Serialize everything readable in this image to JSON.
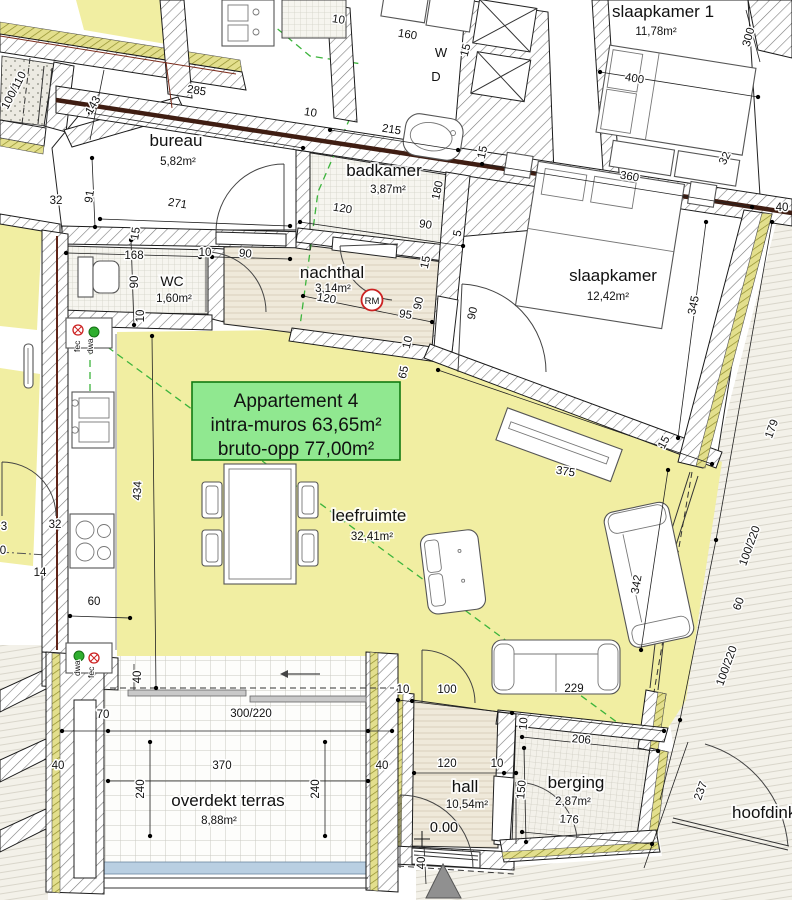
{
  "plan": {
    "info_box": {
      "line1": "Appartement  4",
      "line2": "intra-muros 63,65m²",
      "line3": "bruto-opp 77,00m²"
    },
    "rooms": {
      "bureau": {
        "name": "bureau",
        "area": "5,82m²"
      },
      "badkamer": {
        "name": "badkamer",
        "area": "3,87m²"
      },
      "slaapkamer1": {
        "name": "slaapkamer 1",
        "area": "11,78m²"
      },
      "slaapkamer": {
        "name": "slaapkamer",
        "area": "12,42m²"
      },
      "wc": {
        "name": "WC",
        "area": "1,60m²"
      },
      "nachthal": {
        "name": "nachthal",
        "area": "3,14m²"
      },
      "leefruimte": {
        "name": "leefruimte",
        "area": "32,41m²"
      },
      "terras": {
        "name": "overdekt terras",
        "area": "8,88m²"
      },
      "hall": {
        "name": "hall",
        "area": "10,54m²",
        "level": "0.00"
      },
      "berging": {
        "name": "berging",
        "area": "2,87m²"
      },
      "hoofdinkom": {
        "name": "hoofdinkom"
      }
    },
    "badges": {
      "rm": "RM",
      "w": "W",
      "d": "D",
      "fec": "fec",
      "dwa": "dwa"
    },
    "colors": {
      "room_yellow": "#f1eea2",
      "info_green": "#90e890",
      "info_border": "#117a11",
      "party_wall": "#3f1d12",
      "dash_green": "#3cb43c",
      "badge_red": "#cc2222",
      "terras_blue": "#b9cfe2",
      "insulation": "#e3df8d"
    },
    "dimensions": [
      {
        "t": "100/110",
        "x": 17,
        "y": 92,
        "r": -62
      },
      {
        "t": "143",
        "x": 96,
        "y": 107,
        "r": -60
      },
      {
        "t": "285",
        "x": 196,
        "y": 94,
        "r": 9
      },
      {
        "t": "10",
        "x": 310,
        "y": 116,
        "r": 9
      },
      {
        "t": "32",
        "x": 56,
        "y": 204,
        "r": 0
      },
      {
        "t": "91",
        "x": 93,
        "y": 197,
        "r": -81
      },
      {
        "t": "271",
        "x": 177,
        "y": 207,
        "r": 9
      },
      {
        "t": "15",
        "x": 139,
        "y": 234,
        "r": -81
      },
      {
        "t": "168",
        "x": 134,
        "y": 259,
        "r": 0
      },
      {
        "t": "90",
        "x": 138,
        "y": 282,
        "r": -90
      },
      {
        "t": "10",
        "x": 205,
        "y": 256,
        "r": 0
      },
      {
        "t": "90",
        "x": 245,
        "y": 257,
        "r": 6
      },
      {
        "t": "10",
        "x": 144,
        "y": 316,
        "r": -90
      },
      {
        "t": "10",
        "x": 338,
        "y": 23,
        "r": 9
      },
      {
        "t": "160",
        "x": 407,
        "y": 38,
        "r": 9
      },
      {
        "t": "15",
        "x": 469,
        "y": 51,
        "r": -75
      },
      {
        "t": "215",
        "x": 391,
        "y": 133,
        "r": 9
      },
      {
        "t": "120",
        "x": 342,
        "y": 212,
        "r": 9
      },
      {
        "t": "180",
        "x": 441,
        "y": 191,
        "r": -78
      },
      {
        "t": "90",
        "x": 425,
        "y": 228,
        "r": 9
      },
      {
        "t": "5",
        "x": 461,
        "y": 234,
        "r": -78
      },
      {
        "t": "15",
        "x": 486,
        "y": 153,
        "r": -78
      },
      {
        "t": "400",
        "x": 634,
        "y": 82,
        "r": 9
      },
      {
        "t": "300",
        "x": 752,
        "y": 38,
        "r": -75
      },
      {
        "t": "360",
        "x": 629,
        "y": 180,
        "r": 9
      },
      {
        "t": "32",
        "x": 728,
        "y": 160,
        "r": -62
      },
      {
        "t": "40",
        "x": 782,
        "y": 211,
        "r": 0
      },
      {
        "t": "345",
        "x": 697,
        "y": 306,
        "r": -78
      },
      {
        "t": "90",
        "x": 476,
        "y": 314,
        "r": -78
      },
      {
        "t": "120",
        "x": 326,
        "y": 302,
        "r": 9
      },
      {
        "t": "95",
        "x": 405,
        "y": 318,
        "r": 9
      },
      {
        "t": "90",
        "x": 422,
        "y": 304,
        "r": -78
      },
      {
        "t": "10",
        "x": 411,
        "y": 343,
        "r": -78
      },
      {
        "t": "15",
        "x": 429,
        "y": 263,
        "r": -78
      },
      {
        "t": "65",
        "x": 407,
        "y": 373,
        "r": -78
      },
      {
        "t": "434",
        "x": 141,
        "y": 491,
        "r": -87
      },
      {
        "t": "32",
        "x": 55,
        "y": 528,
        "r": 0
      },
      {
        "t": "14",
        "x": 40,
        "y": 576,
        "r": 0
      },
      {
        "t": "60",
        "x": 94,
        "y": 605,
        "r": 0
      },
      {
        "t": "3",
        "x": 4,
        "y": 530,
        "r": 0
      },
      {
        "t": "0",
        "x": 3,
        "y": 554,
        "r": 0
      },
      {
        "t": "375",
        "x": 565,
        "y": 475,
        "r": 9
      },
      {
        "t": "15",
        "x": 667,
        "y": 444,
        "r": -62
      },
      {
        "t": "342",
        "x": 640,
        "y": 585,
        "r": -80
      },
      {
        "t": "179",
        "x": 775,
        "y": 430,
        "r": -70
      },
      {
        "t": "100/220",
        "x": 753,
        "y": 547,
        "r": -70
      },
      {
        "t": "60",
        "x": 742,
        "y": 605,
        "r": -70
      },
      {
        "t": "100/220",
        "x": 730,
        "y": 667,
        "r": -70
      },
      {
        "t": "237",
        "x": 704,
        "y": 792,
        "r": -70
      },
      {
        "t": "40",
        "x": 141,
        "y": 677,
        "r": -90
      },
      {
        "t": "70",
        "x": 103,
        "y": 718,
        "r": 0
      },
      {
        "t": "300/220",
        "x": 251,
        "y": 717,
        "r": 0
      },
      {
        "t": "370",
        "x": 222,
        "y": 769,
        "r": 0
      },
      {
        "t": "240",
        "x": 144,
        "y": 789,
        "r": -90
      },
      {
        "t": "240",
        "x": 319,
        "y": 789,
        "r": -90
      },
      {
        "t": "40",
        "x": 58,
        "y": 769,
        "r": 0
      },
      {
        "t": "40",
        "x": 382,
        "y": 769,
        "r": 0
      },
      {
        "t": "10",
        "x": 403,
        "y": 693,
        "r": 0
      },
      {
        "t": "100",
        "x": 447,
        "y": 693,
        "r": 0
      },
      {
        "t": "229",
        "x": 574,
        "y": 692,
        "r": 0
      },
      {
        "t": "10",
        "x": 527,
        "y": 724,
        "r": -85
      },
      {
        "t": "206",
        "x": 581,
        "y": 743,
        "r": 5
      },
      {
        "t": "120",
        "x": 447,
        "y": 767,
        "r": 0
      },
      {
        "t": "10",
        "x": 497,
        "y": 767,
        "r": 0
      },
      {
        "t": "150",
        "x": 525,
        "y": 790,
        "r": -85
      },
      {
        "t": "176",
        "x": 569,
        "y": 823,
        "r": 3
      },
      {
        "t": "40",
        "x": 425,
        "y": 863,
        "r": -90
      }
    ]
  }
}
